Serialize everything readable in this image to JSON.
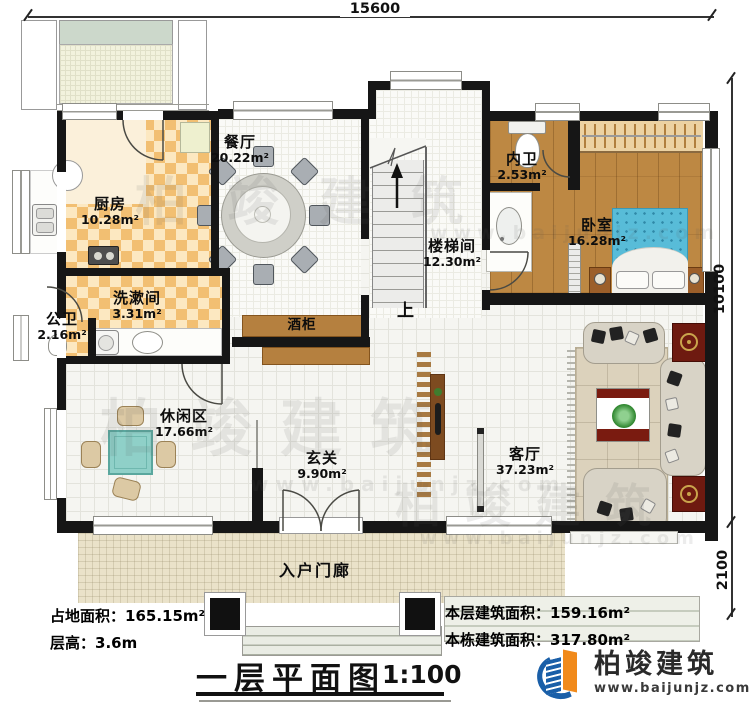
{
  "sheet": {
    "title": "一层平面图",
    "scale": "1:100"
  },
  "dimensions": {
    "top_width": "15600",
    "right_main": "10100",
    "right_porch": "2100"
  },
  "rooms": {
    "kitchen": {
      "name": "厨房",
      "area": "10.28m²"
    },
    "dining": {
      "name": "餐厅",
      "area": "20.22m²"
    },
    "inner_bath": {
      "name": "内卫",
      "area": "2.53m²"
    },
    "bedroom": {
      "name": "卧室",
      "area": "16.28m²"
    },
    "stairwell": {
      "name": "楼梯间",
      "area": "12.30m²"
    },
    "washroom": {
      "name": "洗漱间",
      "area": "3.31m²"
    },
    "public_bath": {
      "name": "公卫",
      "area": "2.16m²"
    },
    "leisure": {
      "name": "休闲区",
      "area": "17.66m²"
    },
    "foyer": {
      "name": "玄关",
      "area": "9.90m²"
    },
    "living": {
      "name": "客厅",
      "area": "37.23m²"
    },
    "porch": {
      "name": "入户门廊"
    }
  },
  "annotations": {
    "wine_cabinet": "酒柜",
    "stairs_up": "上"
  },
  "stats": {
    "land_area": {
      "label": "占地面积：",
      "value": "165.15m²"
    },
    "floor_height": {
      "label": "层高：",
      "value": "3.6m"
    },
    "floor_area": {
      "label": "本层建筑面积：",
      "value": "159.16m²"
    },
    "building_area": {
      "label": "本栋建筑面积：",
      "value": "317.80m²"
    }
  },
  "branding": {
    "company": "柏竣建筑",
    "website": "www.baijunjz.com"
  },
  "watermark": {
    "text": "柏竣建筑",
    "url": "www.baijunjz.com"
  },
  "colors": {
    "wall": "#161616",
    "checker": "#f2bf72",
    "wood_floor": "#bd8843",
    "cabinet_wood": "#b5803f",
    "bed_blue": "#58bcd8",
    "brand_blue": "#1a5fa8",
    "brand_orange": "#f18a1b",
    "accent_red": "#7a1b10"
  }
}
